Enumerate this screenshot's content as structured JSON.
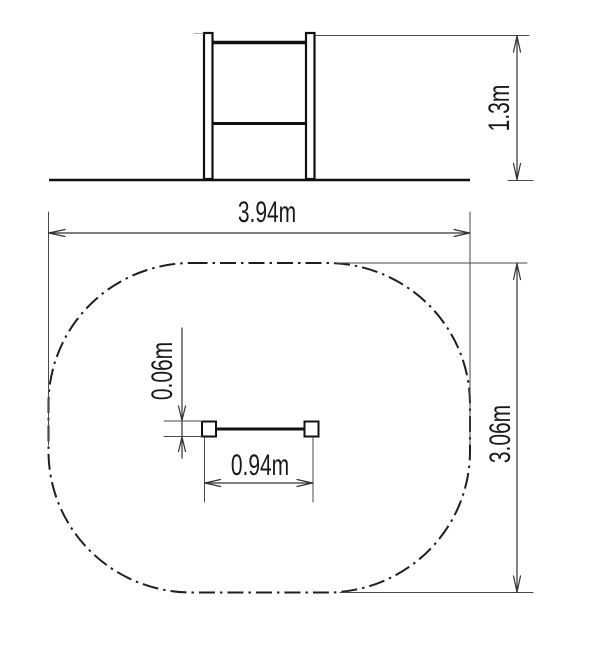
{
  "drawing": {
    "description": "playground-bar-technical-drawing",
    "views": {
      "front_view": "elevation-with-two-posts-and-bars",
      "plan_view": "oval-safety-zone-with-horizontal-bar"
    },
    "dimensions": {
      "front_height": "1.3m",
      "zone_width": "3.94m",
      "zone_height": "3.06m",
      "bar_length": "0.94m",
      "post_thickness": "0.06m"
    },
    "colors": {
      "background": "#ffffff",
      "thick_line": "#111111",
      "thin_line": "#4a4a4a",
      "dash_line": "#1f1f1f",
      "text": "#1a1a1a"
    }
  }
}
